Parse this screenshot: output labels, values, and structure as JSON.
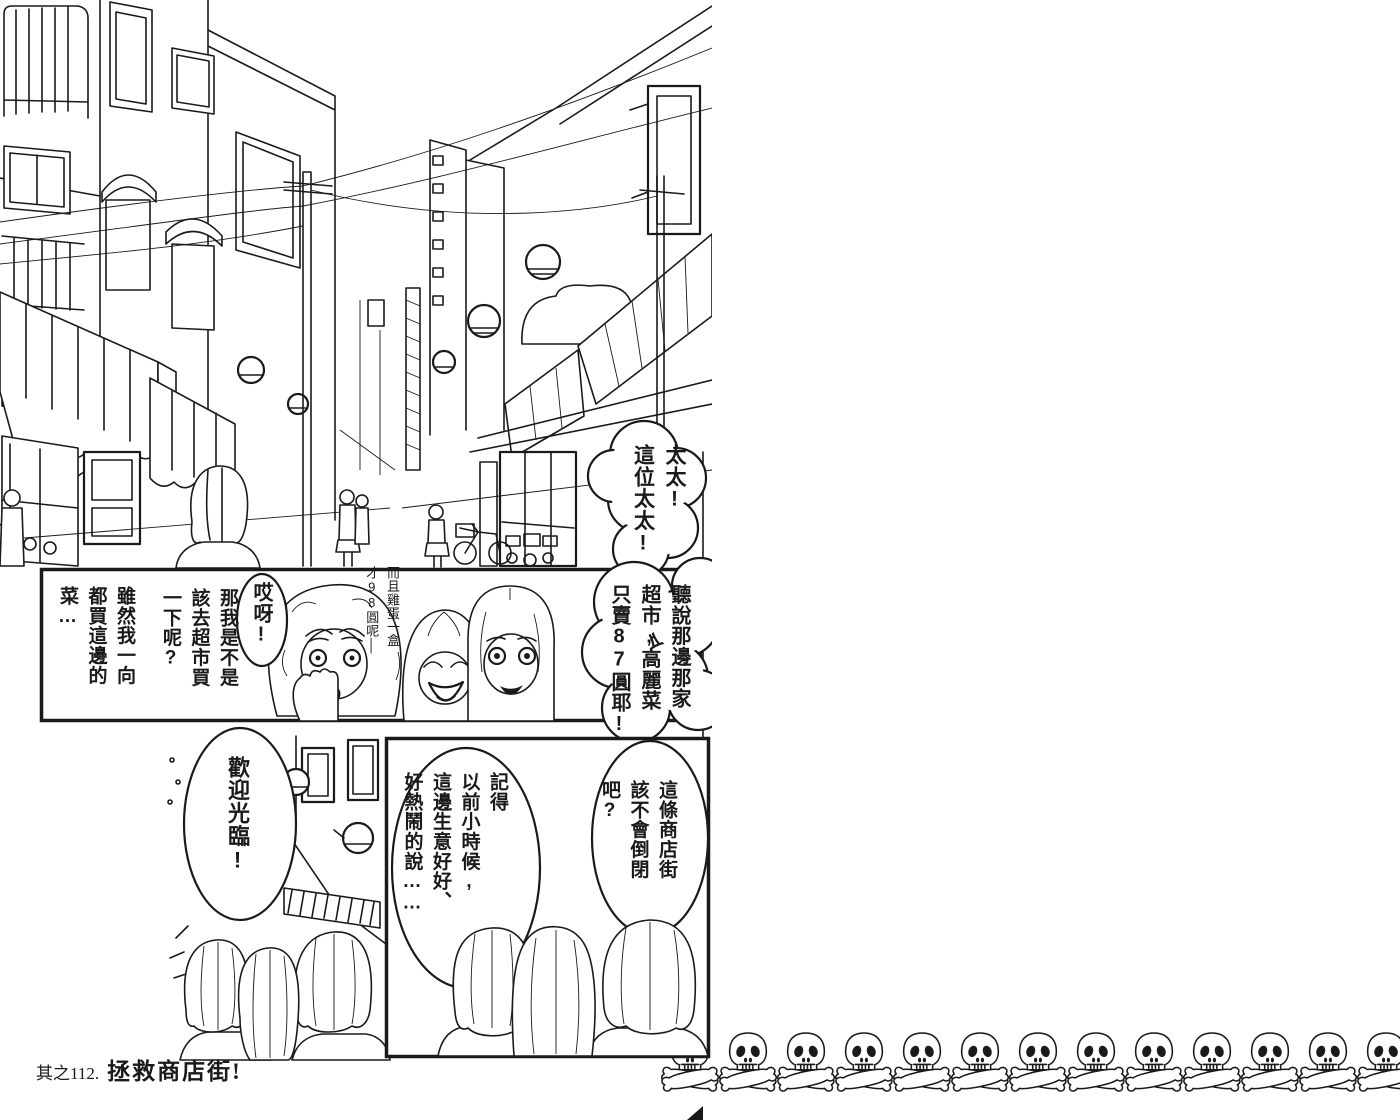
{
  "colors": {
    "ink": "#1a1a1a",
    "paper": "#ffffff"
  },
  "caption": {
    "prefix": "其之112.",
    "title": "拯救商店街!"
  },
  "bubbles": {
    "call_out": "太太!\n這位太太!",
    "supermarket_news": "聽說那邊那家\n超市,高麗菜\n只賣87圓耶!",
    "oh_my": "哎呀!",
    "should_i_go": "那我是不是\n該去超市買\n一下呢?",
    "although": "雖然我一向\n都買這邊的\n菜…",
    "egg_note": "而且雞蛋一盒\n才98圓呢│",
    "welcome": "歡迎光臨!",
    "remember": "記得\n以前小時候,\n這邊生意好好、\n好熱鬧的說……",
    "street_worry": "這條商店街\n該不會倒閉\n吧?"
  },
  "decor": {
    "skull_count": 13,
    "skull_icon": "skull-and-crossbones"
  }
}
